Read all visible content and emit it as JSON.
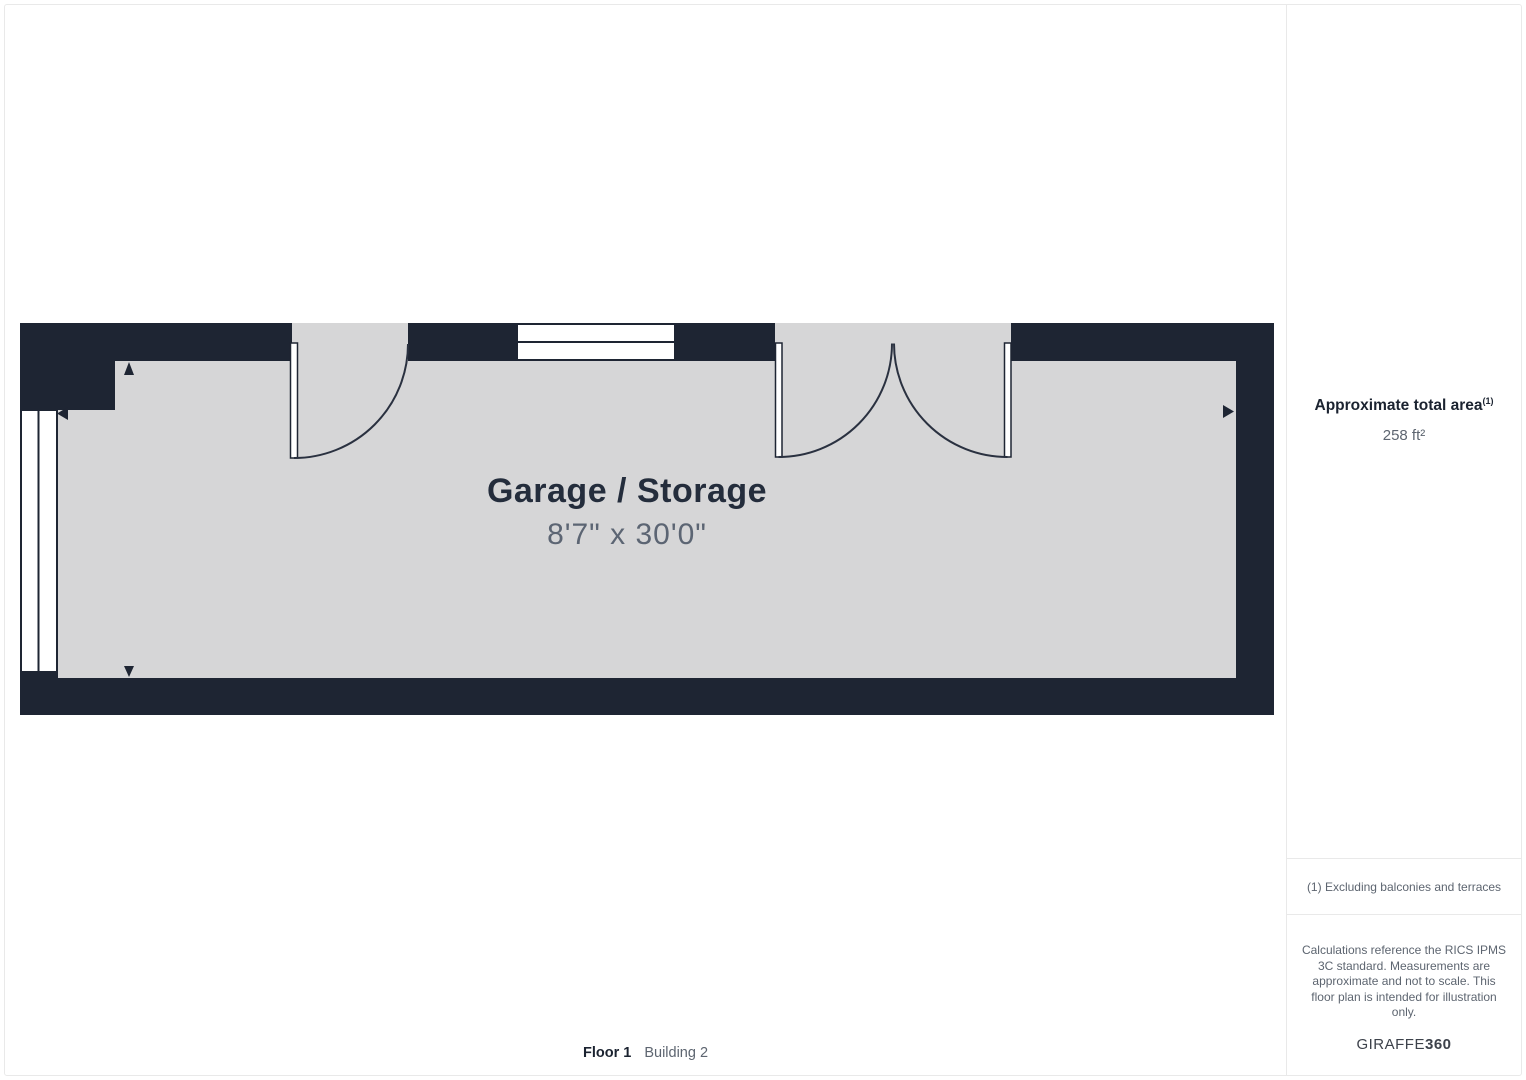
{
  "plan": {
    "room_label": "Garage / Storage",
    "room_dimensions": "8'7\" x 30'0\""
  },
  "footer": {
    "floor": "Floor 1",
    "building": "Building 2"
  },
  "sidebar": {
    "area_title": "Approximate total area",
    "area_footnote_marker": "(1)",
    "area_value": "258 ft²",
    "footnote": "(1) Excluding balconies and terraces",
    "disclaimer": "Calculations reference the RICS IPMS\n3C standard. Measurements are\napproximate and not to scale. This\nfloor plan is intended for illustration\nonly.",
    "brand_name": "GIRAFFE",
    "brand_suffix": "360"
  },
  "colors": {
    "wall": "#1e2533",
    "arc": "#2a3140",
    "floor": "#d6d6d7",
    "room_label": "#242d3c",
    "dimension_text": "#5c6573",
    "sidebar_heading": "#1b2330",
    "sidebar_text": "#5d6570",
    "brand": "#3d424b",
    "divider": "#e9e9e9"
  }
}
